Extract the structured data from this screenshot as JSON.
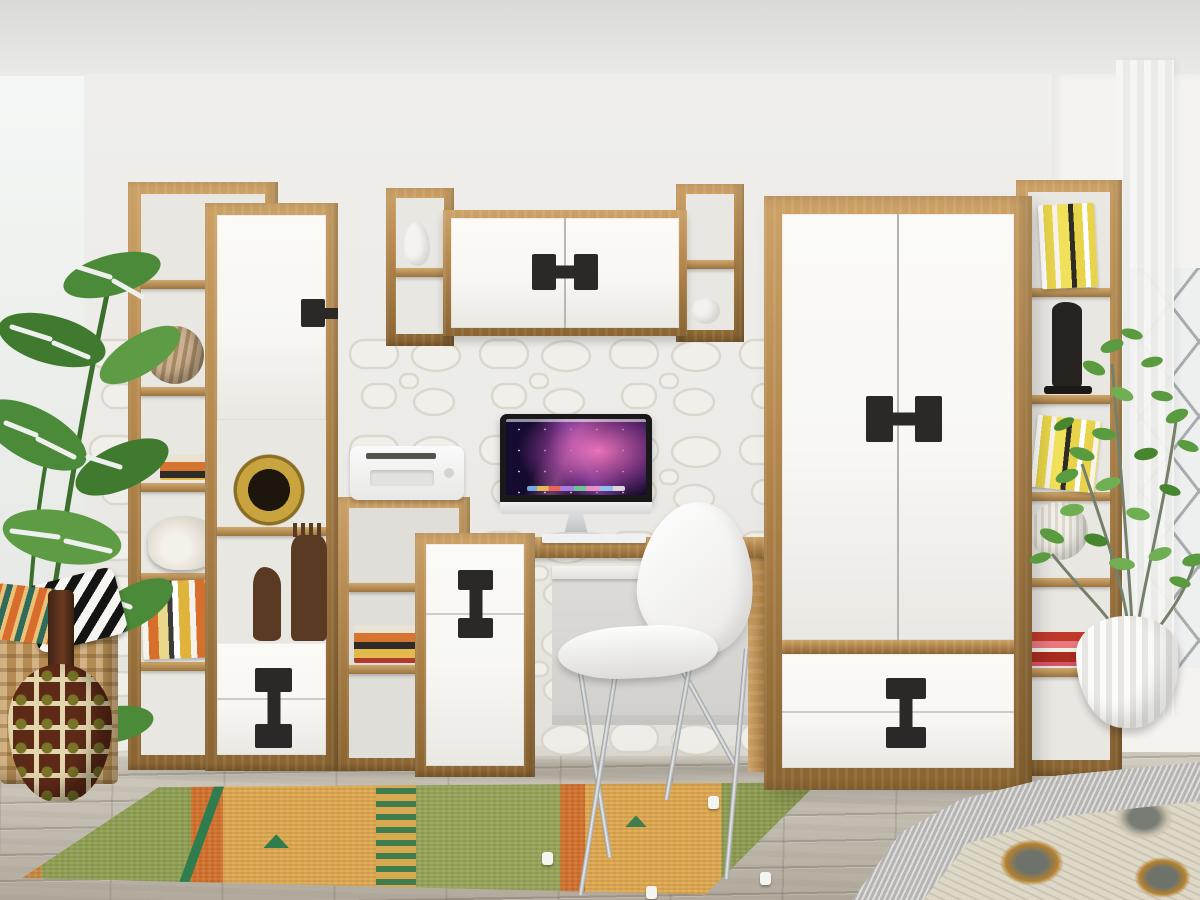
{
  "meta": {
    "title": "Teen room interior photo — oak and white modular furniture set with black dumbbell handles"
  },
  "colors": {
    "ceiling": "#d9d9d7",
    "wall": "#efeeeb",
    "wall_dark": "#e2e0da",
    "stone_line": "#d8d4c9",
    "stone_fill": "#f2f0eb",
    "wood": "#b5894e",
    "wood_light": "#cda267",
    "wood_dark": "#8a6431",
    "front": "#f8f7f3",
    "front_shade": "#e9e8e3",
    "handle": "#2a2927",
    "floor_light": "#d3cdc2",
    "floor_dark": "#b1aa9d",
    "back_panel": "#e9e7e2",
    "rug_green": "#8fa052",
    "rug_orange": "#d4702b",
    "rug_yellow": "#e0a84f",
    "rug_teal": "#2f7d4e",
    "rug_fringe": "#c8893f",
    "leaf": "#4a8a38",
    "leaf_dark": "#3a7230",
    "leaf_light": "#63a44a",
    "branch": "#75806a",
    "leaf_small": "#5a9b40",
    "chrome": "#9aa0a3",
    "chrome_light": "#e8eaeb",
    "screen_base": "#150b30",
    "screen_pink": "#ef6fb4",
    "screen_violet": "#7a3fa8",
    "basket": "#c79d60",
    "vase_base": "#5e2a18",
    "vase_cream": "#e3d5ac",
    "vase_olive": "#7a7428",
    "knit": "#c9c8c5",
    "ikat_base": "#ded8c6",
    "ikat_dark": "#70756e",
    "ikat_gold": "#b5812f",
    "curtain": "#f6f6f4",
    "window_glass": "#edf0ef",
    "lattice": "#a9adaf",
    "frame": "#9aa0a2"
  },
  "scene": {
    "room": [
      "ceiling",
      "white walls",
      "3d-stone accent wall",
      "left window light",
      "right window with diagonal lattice",
      "sheer curtain",
      "weathered gray wood plank floor"
    ],
    "furniture": [
      {
        "name": "open-shelf-tower-left",
        "items": [
          "woven ball vase",
          "book stack",
          "nautilus shell ornament",
          "leaning books"
        ]
      },
      {
        "name": "tall-cabinet-left",
        "items": [
          "white door with black handle",
          "gold ring mask",
          "two wooden figurines",
          "two white drawers with black I-handle"
        ]
      },
      {
        "name": "wall-cabinet-center",
        "items": [
          "white double doors with black dumbbell handle",
          "white pear ornament",
          "white apple ornament"
        ]
      },
      {
        "name": "low-open-shelf",
        "items": [
          "white printer on top",
          "row of books"
        ]
      },
      {
        "name": "desk",
        "items": [
          "iMac computer",
          "white keyboard",
          "mouse",
          "keyboard tray"
        ]
      },
      {
        "name": "narrow-drawer-cabinet",
        "items": [
          "drawer and door with black I-handle"
        ]
      },
      {
        "name": "white-chair-chrome-legs"
      },
      {
        "name": "wardrobe",
        "items": [
          "two white doors with black dumbbell handle",
          "two white drawers with black I-handle"
        ]
      },
      {
        "name": "open-shelf-tower-right",
        "items": [
          "yellow books",
          "black abstract figurine",
          "leaning books",
          "white ribbed sphere",
          "red book stack"
        ]
      }
    ],
    "decor": [
      "monstera plant",
      "wicker basket",
      "black-white triangle pillow",
      "orange-teal kilim pillow",
      "patterned gourd vase",
      "ficus plant in white ribbed pot",
      "orange-green runner rug",
      "bed corner with gray knit and ikat blankets"
    ],
    "computer": {
      "screen_wallpaper": "purple-pink galaxy wallpaper with translucent dock"
    }
  }
}
